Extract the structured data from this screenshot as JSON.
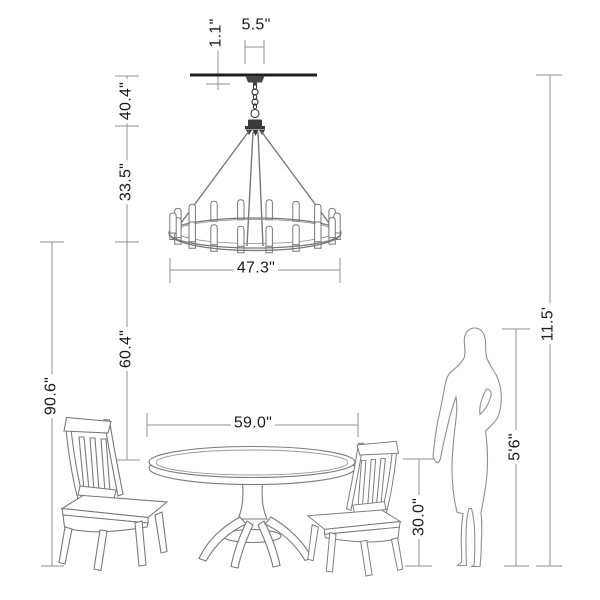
{
  "page": {
    "background": "#ffffff"
  },
  "diagram": {
    "subject": "Chandelier and round dining table dimension diagram with two chairs and person for scale",
    "style": {
      "dimension_line_color": "#909090",
      "drawing_line_color": "#7a7a7a",
      "dark_fixture_color": "#3a3a3a",
      "text_color": "#1b1b1b"
    },
    "measurements": {
      "canopy_height": "1.1\"",
      "canopy_width": "5.5\"",
      "ceiling_to_fixture": "40.4\"",
      "fixture_height": "33.5\"",
      "fixture_diameter": "47.3\"",
      "fixture_to_tabletop": "60.4\"",
      "fixture_bottom_to_floor": "90.6\"",
      "table_diameter": "59.0\"",
      "tabletop_height": "30.0\"",
      "person_height": "5'6\"",
      "ceiling_to_floor": "11.5'"
    }
  }
}
